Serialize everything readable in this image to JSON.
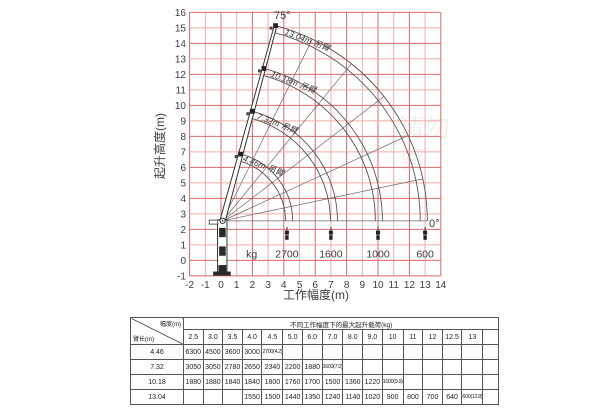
{
  "chart_data": {
    "type": "line",
    "title": "",
    "xlabel": "工作幅度(m)",
    "ylabel": "起升高度(m)",
    "xlim": [
      -2,
      14
    ],
    "ylim": [
      -1,
      16
    ],
    "x_ticks": [
      "-2",
      "-1",
      "0",
      "1",
      "2",
      "3",
      "4",
      "5",
      "6",
      "7",
      "8",
      "9",
      "10",
      "11",
      "12",
      "13",
      "14"
    ],
    "y_ticks": [
      "16",
      "15",
      "14",
      "13",
      "12",
      "11",
      "10",
      "9",
      "8",
      "7",
      "6",
      "5",
      "4",
      "3",
      "2",
      "1",
      "0",
      "-1"
    ],
    "grid": {
      "on": true,
      "step": 1,
      "color_major": "#d96868",
      "color_minor": "#f2aaaa"
    },
    "pivot": {
      "x": 0.1,
      "y": 2.55
    },
    "max_angle_label": "75°",
    "min_angle_label": "0°",
    "spoke_angles_deg": [
      0,
      12,
      25,
      38,
      51,
      64,
      75
    ],
    "booms": [
      {
        "length_m": 4.46,
        "label": "4.46m 吊臂"
      },
      {
        "length_m": 7.32,
        "label": "7.32m 吊臂"
      },
      {
        "length_m": 10.18,
        "label": "10.18m 吊臂"
      },
      {
        "length_m": 13.04,
        "label": "13.04m 吊臂"
      }
    ],
    "tip_loads": [
      {
        "radius_m": 4.2,
        "label": "2700"
      },
      {
        "radius_m": 7.0,
        "label": "1600"
      },
      {
        "radius_m": 10.0,
        "label": "1000"
      },
      {
        "radius_m": 13.0,
        "label": "600"
      }
    ],
    "load_unit_label": "kg",
    "legend": null
  },
  "table": {
    "title": "不同工作幅度下的最大起升载荷(kg)",
    "corner": {
      "top_right": "幅度(m)",
      "bottom_left": "臂长(m)"
    },
    "radius_headers": [
      "2.5",
      "3.0",
      "3.5",
      "4.0",
      "4.5",
      "5.0",
      "6.0",
      "7.0",
      "8.0",
      "9.0",
      "10",
      "11",
      "12",
      "12.5",
      "13",
      ""
    ],
    "rows": [
      {
        "boom": "4.46",
        "values": [
          "6300",
          "4500",
          "3600",
          "3000",
          "2700(4.2)",
          "",
          "",
          "",
          "",
          "",
          "",
          "",
          "",
          "",
          "",
          ""
        ]
      },
      {
        "boom": "7.32",
        "values": [
          "3050",
          "3050",
          "2780",
          "2650",
          "2340",
          "2200",
          "1880",
          "1600(7.0)",
          "",
          "",
          "",
          "",
          "",
          "",
          "",
          ""
        ]
      },
      {
        "boom": "10.18",
        "values": [
          "1880",
          "1880",
          "1840",
          "1840",
          "1800",
          "1760",
          "1700",
          "1500",
          "1360",
          "1220",
          "1000(9.9)",
          "",
          "",
          "",
          "",
          ""
        ]
      },
      {
        "boom": "13.04",
        "values": [
          "",
          "",
          "",
          "1550",
          "1500",
          "1440",
          "1350",
          "1240",
          "1140",
          "1020",
          "900",
          "800",
          "700",
          "640",
          "600(12.8)",
          ""
        ]
      }
    ]
  },
  "watermarks": [
    {
      "text": "请勿"
    },
    {
      "text": "蔡"
    }
  ]
}
